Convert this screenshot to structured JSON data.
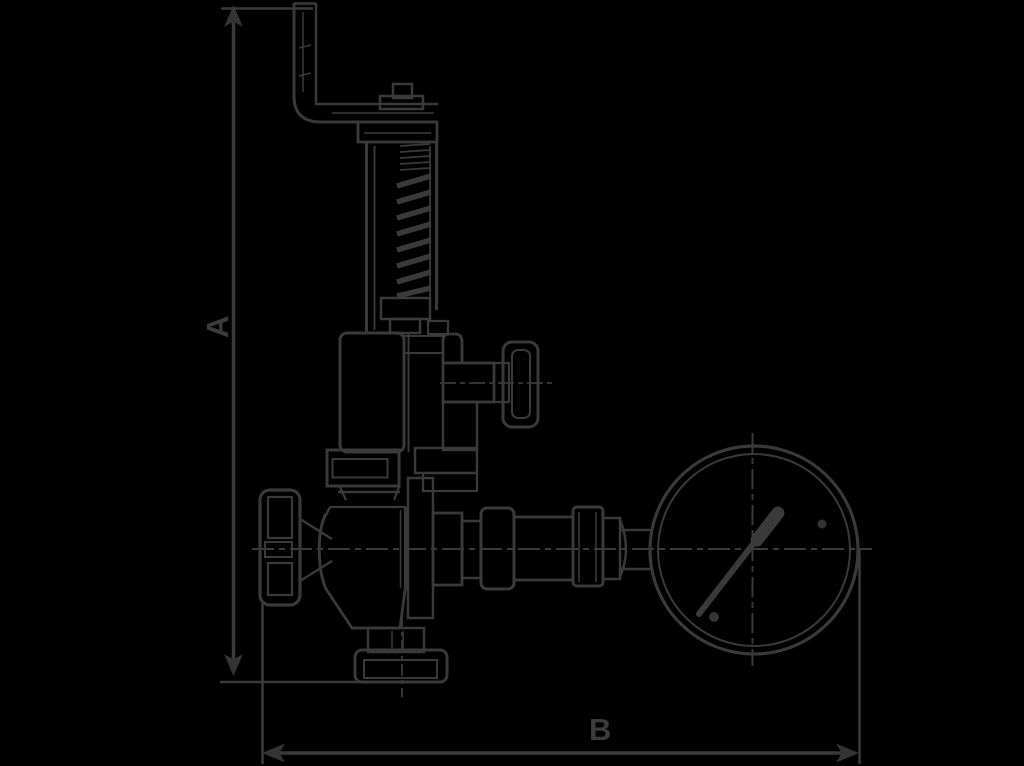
{
  "diagram": {
    "type": "technical-drawing",
    "subject": "safety relief valve with pressure gauge, dimensioned outline drawing",
    "dim_a_label": "A",
    "dim_b_label": "B"
  },
  "colors": {
    "background": "#000000",
    "line": "#3a3a3a",
    "solid": "#343434"
  }
}
